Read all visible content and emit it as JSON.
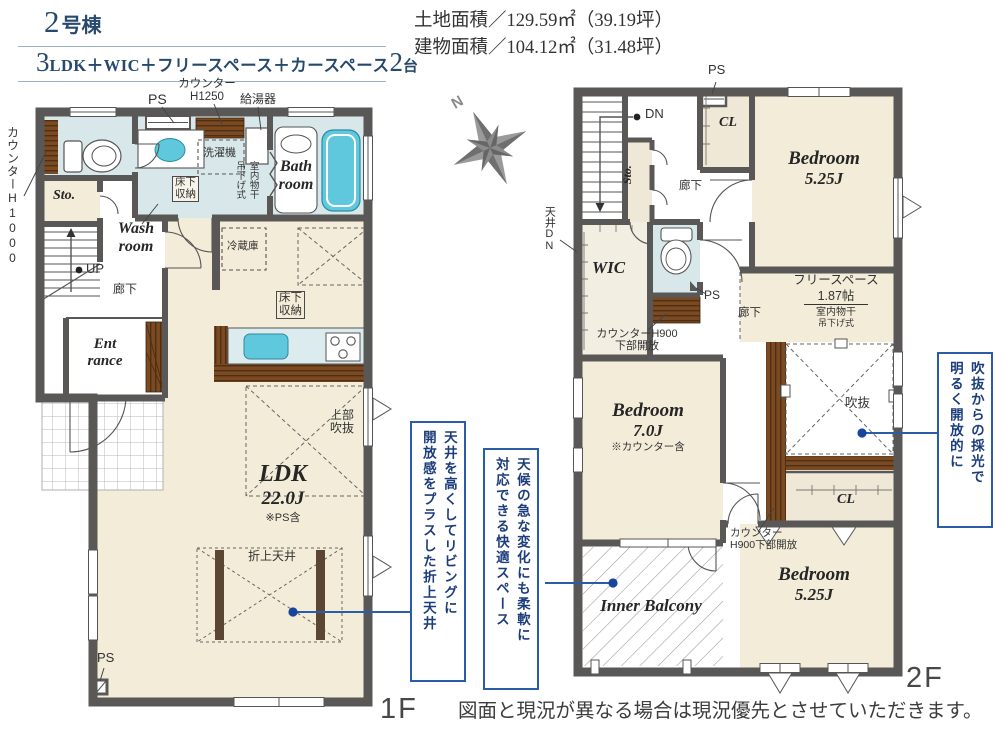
{
  "header": {
    "building_no": "2",
    "building_suffix": "号棟",
    "plan_prefix_num": "3",
    "plan_text": "LDK＋WIC＋フリースペース＋カースペース",
    "plan_cars_num": "2",
    "plan_cars_unit": "台",
    "land_area": "土地面積／129.59㎡（39.19坪）",
    "building_area": "建物面積／104.12㎡（31.48坪）"
  },
  "compass": {
    "north": "N"
  },
  "floor1": {
    "floor_label": "1F",
    "labels": {
      "counter_h1000": "カウンターH1000",
      "ps_top": "PS",
      "counter_h1250_1": "カウンター",
      "counter_h1250_2": "H1250",
      "water_heater": "給湯器",
      "washer": "洗濯機",
      "indoor_drying_1": "室内物干",
      "indoor_drying_2": "吊下げ式",
      "bath_1": "Bath",
      "bath_2": "room",
      "storage": "Sto.",
      "up": "UP",
      "wash_1": "Wash",
      "wash_2": "room",
      "hallway": "廊下",
      "underfloor_1a": "床下",
      "underfloor_1b": "収納",
      "entrance_1": "Ent",
      "entrance_2": "rance",
      "fridge": "冷蔵庫",
      "underfloor_2a": "床下",
      "underfloor_2b": "収納",
      "upper_void_1": "上部",
      "upper_void_2": "吹抜",
      "ldk": "LDK",
      "ldk_size": "22.0J",
      "ldk_note": "※PS含",
      "coffered": "折上天井",
      "ps_bottom": "PS"
    }
  },
  "floor2": {
    "floor_label": "2F",
    "labels": {
      "dn": "DN",
      "ps_top": "PS",
      "cl_top": "CL",
      "bedroom1": "Bedroom",
      "bedroom1_size": "5.25J",
      "storage": "Sto.",
      "hallway1": "廊下",
      "ceiling_dn": "天井DN",
      "wic": "WIC",
      "ps_mid": "PS",
      "counter1_1": "カウンターH900",
      "counter1_2": "下部開放",
      "hallway2": "廊下",
      "free_space": "フリースペース",
      "free_space_size": "1.87帖",
      "drying_1": "室内物干",
      "drying_2": "吊下げ式",
      "void": "吹抜",
      "cl_bottom": "CL",
      "bedroom2": "Bedroom",
      "bedroom2_size": "7.0J",
      "bedroom2_note": "※カウンター含",
      "counter2_1": "カウンター",
      "counter2_2": "H900下部開放",
      "inner_balcony": "Inner Balcony",
      "bedroom3": "Bedroom",
      "bedroom3_size": "5.25J"
    }
  },
  "callouts": {
    "coffered": {
      "line1": "天井を高くしてリビングに",
      "line2": "開放感をプラスした折上天井"
    },
    "balcony": {
      "line1": "天候の急な変化にも柔軟に",
      "line2": "対応できる快適スペース"
    },
    "void": {
      "line1": "吹抜からの採光で",
      "line2": "明るく開放的に"
    }
  },
  "disclaimer": "図面と現況が異なる場合は現況優先とさせていただきます。",
  "colors": {
    "wall": "#5a5856",
    "floor_beige": "#f2ecd8",
    "floor_blue": "#d8e8ea",
    "fixture_cyan": "#5fc8dc",
    "wood": "#7a4a22",
    "accent_blue": "#2b5ca8",
    "title_navy": "#27496d"
  }
}
